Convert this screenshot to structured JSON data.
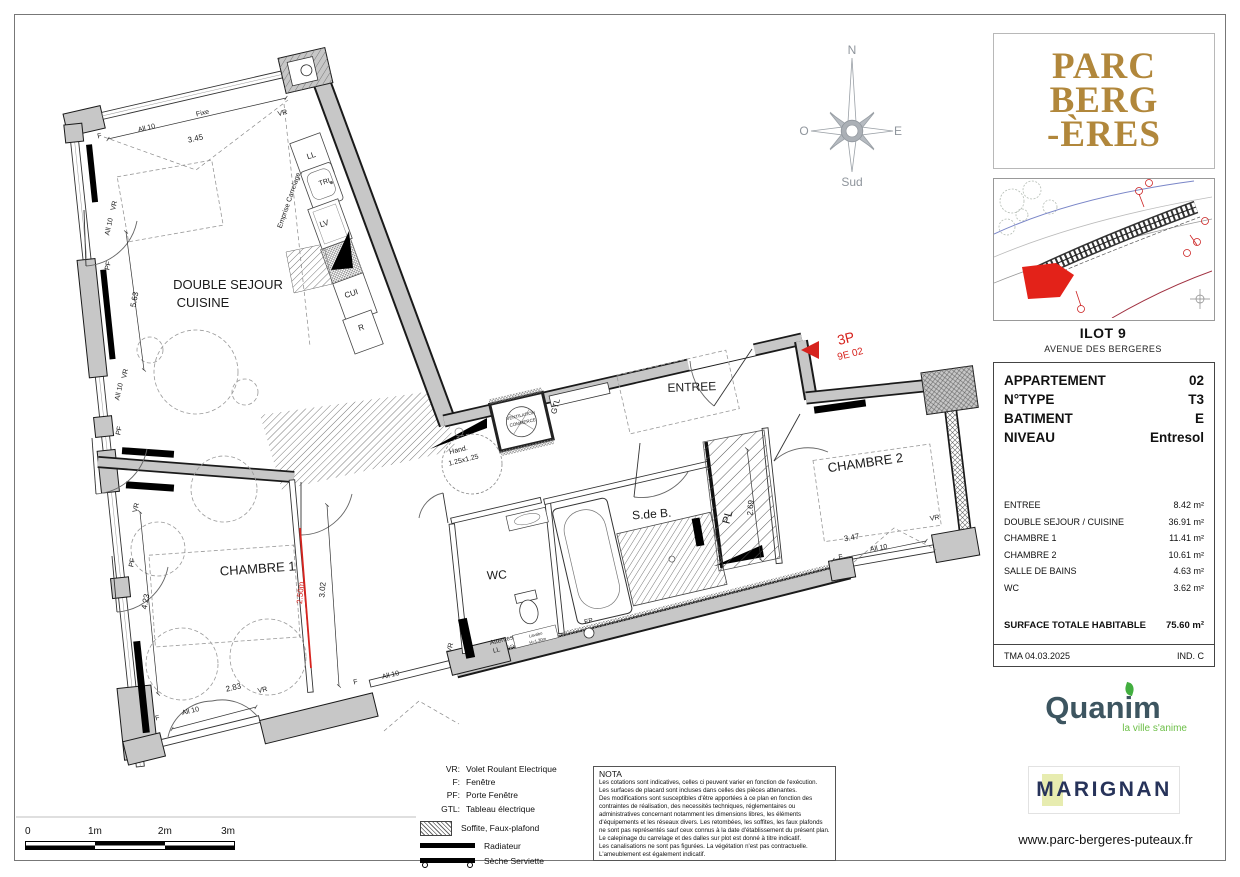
{
  "project": {
    "logo_lines": [
      "PARC",
      "BERG",
      "-ÈRES"
    ]
  },
  "site": {
    "title": "ILOT 9",
    "subtitle": "AVENUE DES BERGERES"
  },
  "info_panel": {
    "header_rows": [
      {
        "label": "APPARTEMENT",
        "value": "02"
      },
      {
        "label": "N°TYPE",
        "value": "T3"
      },
      {
        "label": "BATIMENT",
        "value": "E"
      },
      {
        "label": "NIVEAU",
        "value": "Entresol"
      }
    ],
    "area_rows": [
      {
        "label": "ENTREE",
        "value": "8.42 m²"
      },
      {
        "label": "DOUBLE SEJOUR / CUISINE",
        "value": "36.91 m²"
      },
      {
        "label": "CHAMBRE 1",
        "value": "11.41 m²"
      },
      {
        "label": "CHAMBRE 2",
        "value": "10.61 m²"
      },
      {
        "label": "SALLE DE BAINS",
        "value": "4.63 m²"
      },
      {
        "label": "WC",
        "value": "3.62 m²"
      }
    ],
    "total": {
      "label": "SURFACE TOTALE HABITABLE",
      "value": "75.60 m²"
    },
    "footer": {
      "left": "TMA  04.03.2025",
      "right": "IND. C"
    }
  },
  "branding": {
    "quanim": "Quanim",
    "quanim_tagline": "la ville s'anime",
    "marignan": "MARIGNAN",
    "website": "www.parc-bergeres-puteaux.fr"
  },
  "legend": {
    "rows": [
      {
        "abbr": "VR:",
        "label": "Volet Roulant Electrique"
      },
      {
        "abbr": "F:",
        "label": "Fenêtre"
      },
      {
        "abbr": "PF:",
        "label": "Porte Fenêtre"
      },
      {
        "abbr": "GTL:",
        "label": "Tableau électrique"
      }
    ],
    "soffite": "Soffite, Faux-plafond",
    "radiateur": "Radiateur",
    "seche_serviette": "Sèche Serviette"
  },
  "nota": {
    "title": "NOTA",
    "body": "Les cotations sont indicatives, celles ci peuvent varier en fonction de l'exécution.\nLes surfaces de placard sont incluses dans celles des pièces attenantes.\nDes modifications sont susceptibles d'être apportées à ce plan en fonction des contraintes de réalisation, des necessités techniques, réglementaires ou administratives concernant notamment les dimensions libres, les éléments d'équipements et les réseaux divers. Les retombées, les soffites, les faux plafonds ne sont pas représentés sauf ceux connus à la date d'établissement du présent plan. Le calepinage du carrelage et des dalles sur plot est donné à titre indicatif.\nLes canalisations ne sont pas figurées. La végétation n'est pas contractuelle.\nL'ameublement est également indicatif."
  },
  "scalebar": [
    "0",
    "1m",
    "2m",
    "3m"
  ],
  "plan": {
    "annotations": [
      {
        "t": "DOUBLE SEJOUR",
        "x": 228,
        "y": 289,
        "s": 13,
        "n": "room-label-sejour"
      },
      {
        "t": "CUISINE",
        "x": 203,
        "y": 307,
        "s": 13,
        "n": "room-label-cuisine"
      },
      {
        "t": "ENTREE",
        "x": 692,
        "y": 391,
        "r": -2,
        "s": 12,
        "n": "room-label-entree"
      },
      {
        "t": "CHAMBRE 1",
        "x": 258,
        "y": 573,
        "r": -4,
        "s": 13,
        "n": "room-label-chambre1"
      },
      {
        "t": "CHAMBRE 2",
        "x": 866,
        "y": 467,
        "r": -8,
        "s": 13,
        "n": "room-label-chambre2"
      },
      {
        "t": "S.de B.",
        "x": 652,
        "y": 518,
        "r": -4,
        "s": 12,
        "n": "room-label-sdb"
      },
      {
        "t": "WC",
        "x": 497,
        "y": 579,
        "r": -3,
        "s": 12,
        "n": "room-label-wc"
      },
      {
        "t": "PL",
        "x": 731,
        "y": 518,
        "r": -75,
        "s": 11,
        "n": "room-label-pl"
      },
      {
        "t": "3P",
        "x": 847,
        "y": 343,
        "r": -14,
        "s": 14,
        "c": "#d6231e",
        "n": "unit-type-label"
      },
      {
        "t": "9E 02",
        "x": 851,
        "y": 357,
        "r": -14,
        "s": 10,
        "c": "#d6231e",
        "n": "unit-code-label"
      },
      {
        "t": "F",
        "x": 100,
        "y": 138,
        "r": -13,
        "s": 7
      },
      {
        "t": "All 10",
        "x": 147,
        "y": 130,
        "r": -13,
        "s": 7
      },
      {
        "t": "3.45",
        "x": 196,
        "y": 141,
        "r": -13,
        "s": 8
      },
      {
        "t": "Fixe",
        "x": 203,
        "y": 115,
        "r": -13,
        "s": 7
      },
      {
        "t": "VR",
        "x": 283,
        "y": 115,
        "r": -13,
        "s": 7
      },
      {
        "t": "VR",
        "x": 116,
        "y": 206,
        "r": -78,
        "s": 7
      },
      {
        "t": "All 10",
        "x": 111,
        "y": 227,
        "r": -78,
        "s": 7
      },
      {
        "t": "PF",
        "x": 110,
        "y": 266,
        "r": -78,
        "s": 7
      },
      {
        "t": "5.63",
        "x": 137,
        "y": 300,
        "r": -80,
        "s": 8
      },
      {
        "t": "VR",
        "x": 127,
        "y": 374,
        "r": -78,
        "s": 7
      },
      {
        "t": "All 10",
        "x": 121,
        "y": 392,
        "r": -78,
        "s": 7
      },
      {
        "t": "PF",
        "x": 121,
        "y": 431,
        "r": -78,
        "s": 7
      },
      {
        "t": "VR",
        "x": 138,
        "y": 508,
        "r": -78,
        "s": 7
      },
      {
        "t": "PF",
        "x": 134,
        "y": 563,
        "r": -78,
        "s": 7
      },
      {
        "t": "4.23",
        "x": 148,
        "y": 602,
        "r": -80,
        "s": 8
      },
      {
        "t": "F",
        "x": 158,
        "y": 720,
        "r": -14,
        "s": 7
      },
      {
        "t": "All 10",
        "x": 191,
        "y": 713,
        "r": -14,
        "s": 7
      },
      {
        "t": "2.83",
        "x": 234,
        "y": 690,
        "r": -13,
        "s": 8
      },
      {
        "t": "VR",
        "x": 263,
        "y": 692,
        "r": -13,
        "s": 7
      },
      {
        "t": "F",
        "x": 356,
        "y": 684,
        "r": -13,
        "s": 7
      },
      {
        "t": "All 10",
        "x": 391,
        "y": 677,
        "r": -13,
        "s": 7
      },
      {
        "t": "2.50m",
        "x": 303,
        "y": 593,
        "r": -85,
        "s": 8,
        "c": "#d6231e"
      },
      {
        "t": "3.02",
        "x": 325,
        "y": 590,
        "r": -85,
        "s": 8
      },
      {
        "t": "Hand.",
        "x": 459,
        "y": 452,
        "r": -14,
        "s": 7
      },
      {
        "t": "1.25x1.25",
        "x": 464,
        "y": 462,
        "r": -14,
        "s": 7
      },
      {
        "t": "VENTILATION",
        "x": 521,
        "y": 417,
        "r": -13,
        "s": 4.5
      },
      {
        "t": "COMMERCE",
        "x": 523,
        "y": 424,
        "r": -13,
        "s": 4.5
      },
      {
        "t": "GTL",
        "x": 558,
        "y": 407,
        "r": -75,
        "s": 8
      },
      {
        "t": "Emprise Carrelage",
        "x": 291,
        "y": 201,
        "r": -71,
        "s": 7
      },
      {
        "t": "LL",
        "x": 312,
        "y": 158,
        "r": -18,
        "s": 8
      },
      {
        "t": "TRI",
        "x": 325,
        "y": 184,
        "r": -18,
        "s": 7
      },
      {
        "t": "LV",
        "x": 325,
        "y": 226,
        "r": -18,
        "s": 8
      },
      {
        "t": "CUI",
        "x": 352,
        "y": 296,
        "r": -18,
        "s": 8
      },
      {
        "t": "R",
        "x": 362,
        "y": 330,
        "r": -18,
        "s": 8
      },
      {
        "t": "Attentes",
        "x": 502,
        "y": 642,
        "r": -14,
        "s": 6.5
      },
      {
        "t": "LL",
        "x": 497,
        "y": 652,
        "r": -14,
        "s": 6.5
      },
      {
        "t": "Lavabo",
        "x": 536,
        "y": 636,
        "r": -14,
        "s": 4.2
      },
      {
        "t": "H=1.30m",
        "x": 538,
        "y": 642,
        "r": -14,
        "s": 4.2
      },
      {
        "t": "EP",
        "x": 589,
        "y": 623,
        "r": -13,
        "s": 6.5
      },
      {
        "t": "VR",
        "x": 452,
        "y": 648,
        "r": -76,
        "s": 7
      },
      {
        "t": "F",
        "x": 841,
        "y": 559,
        "r": -10,
        "s": 7
      },
      {
        "t": "3.47",
        "x": 852,
        "y": 540,
        "r": -10,
        "s": 8
      },
      {
        "t": "All 10",
        "x": 879,
        "y": 550,
        "r": -10,
        "s": 7
      },
      {
        "t": "VR",
        "x": 935,
        "y": 520,
        "r": -10,
        "s": 7
      },
      {
        "t": "2.69",
        "x": 753,
        "y": 508,
        "r": -85,
        "s": 8
      },
      {
        "t": "N",
        "x": 852,
        "y": 54,
        "s": 12,
        "c": "#8f959c",
        "f": 1,
        "n": "compass-north-label"
      },
      {
        "t": "O",
        "x": 804,
        "y": 135,
        "s": 12,
        "c": "#8f959c",
        "f": 1,
        "n": "compass-west-label"
      },
      {
        "t": "E",
        "x": 898,
        "y": 135,
        "s": 12,
        "c": "#8f959c",
        "f": 1,
        "n": "compass-east-label"
      },
      {
        "t": "Sud",
        "x": 852,
        "y": 186,
        "s": 12,
        "c": "#8f959c",
        "f": 1,
        "n": "compass-south-label"
      }
    ]
  }
}
